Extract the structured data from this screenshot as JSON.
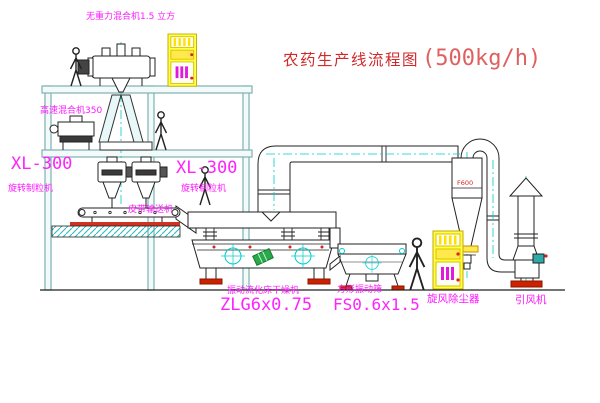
{
  "diagram": {
    "title": "农药生产线流程图",
    "capacity": "(500kg/h)",
    "equipment_labels": {
      "gravity_mixer": "无重力混合机1.5 立方",
      "high_speed_mixer": "高速混合机350",
      "granulator_left_model": "XL-300",
      "granulator_left_name": "旋转制粒机",
      "granulator_mid_model": "XL-300",
      "granulator_mid_name": "旋转制粒机",
      "belt_conveyor": "皮带输送机",
      "dryer_name": "振动流化床干燥机",
      "dryer_model": "ZLG6x0.75",
      "sieve_name": "方形振动筛",
      "sieve_model": "FS0.6x1.5",
      "cyclone_name": "旋风除尘器",
      "cyclone_tag": "F600",
      "fan_name": "引风机"
    },
    "colors": {
      "centerline_cyan": "#00cccc",
      "label_magenta": "#ff18ff",
      "title_red": "#cf2a2a",
      "cabinet_yellow": "#ffff45",
      "accent_red": "#cc2200",
      "motor_green": "#2aa84a",
      "frame_teal": "#7fb0b0"
    }
  }
}
